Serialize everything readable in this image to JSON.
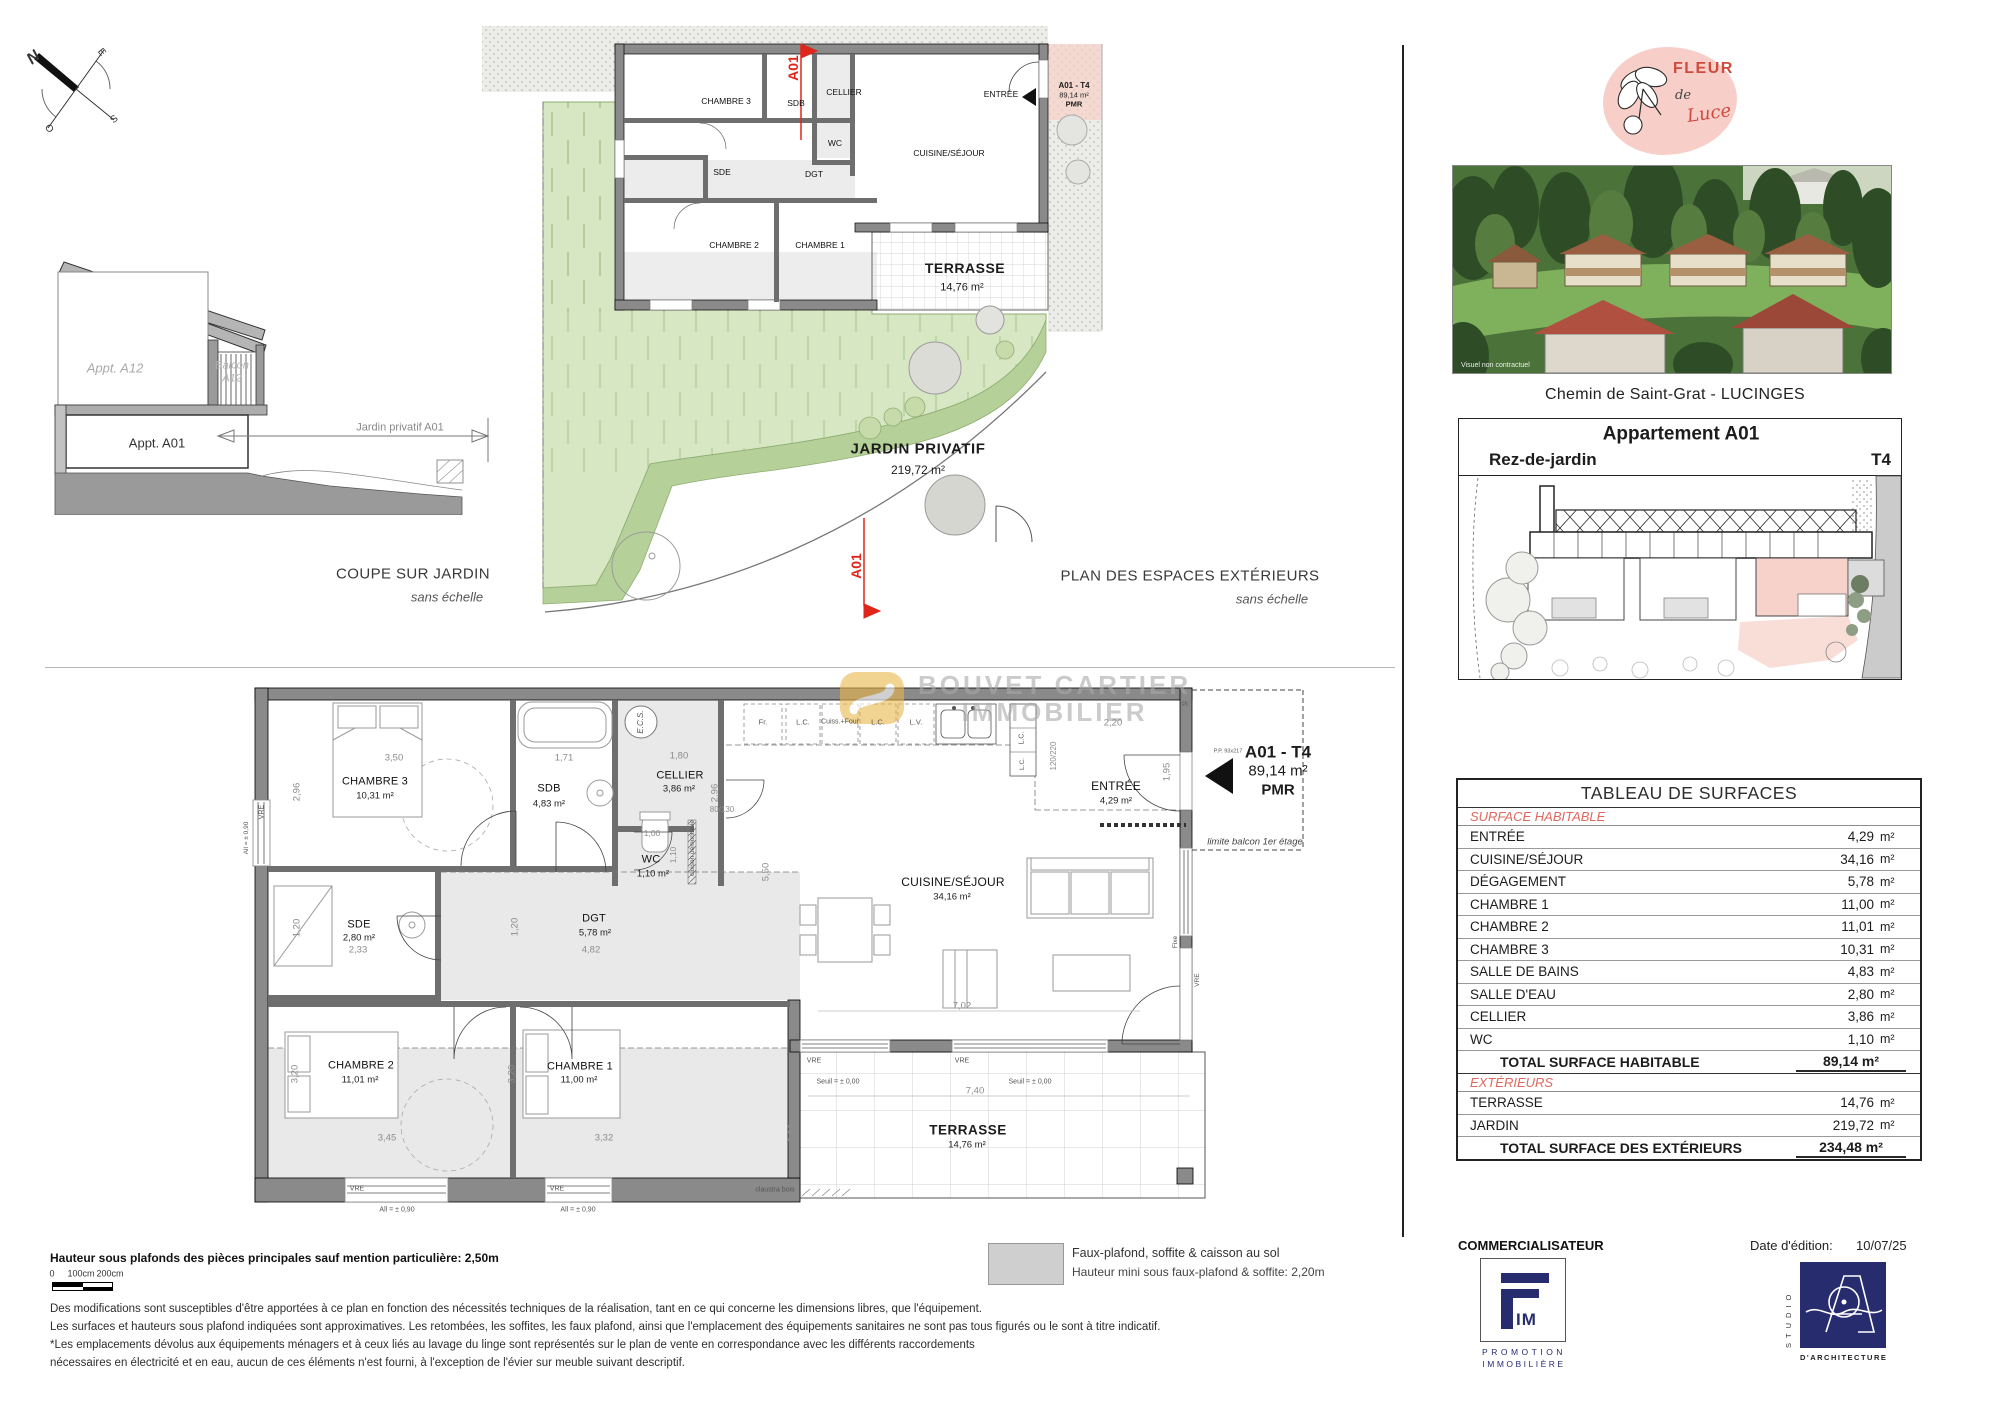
{
  "compass": {
    "n": "N",
    "e": "E",
    "s": "S",
    "o": "O"
  },
  "coupe": {
    "appt_a12": "Appt. A12",
    "balcon_l1": "Balcon",
    "balcon_l2": "A12",
    "appt_a01": "Appt. A01",
    "jardin_dim": "Jardin privatif A01",
    "caption": "COUPE SUR JARDIN",
    "caption_sub": "sans échelle"
  },
  "ext_plan": {
    "caption": "PLAN DES ESPACES EXTÉRIEURS",
    "caption_sub": "sans échelle",
    "jardin_name": "JARDIN PRIVATIF",
    "jardin_area": "219,72 m²",
    "terrasse_name": "TERRASSE",
    "terrasse_area": "14,76 m²",
    "marker": "A01",
    "unit_name": "A01 - T4",
    "unit_area": "89,14 m²",
    "unit_pmr": "PMR",
    "rooms": {
      "chambre3": "CHAMBRE 3",
      "sdb": "SDB",
      "cellier": "CELLIER",
      "entree": "ENTRÉE",
      "cuisine": "CUISINE/SÉJOUR",
      "wc": "WC",
      "sde": "SDE",
      "dgt": "DGT",
      "chambre2": "CHAMBRE 2",
      "chambre1": "CHAMBRE 1"
    }
  },
  "main_plan": {
    "unit_name": "A01 - T4",
    "unit_area": "89,14 m²",
    "unit_pmr": "PMR",
    "rooms": {
      "chambre3": {
        "name": "CHAMBRE 3",
        "area": "10,31 m²"
      },
      "sdb": {
        "name": "SDB",
        "area": "4,83 m²"
      },
      "cellier": {
        "name": "CELLIER",
        "area": "3,86 m²"
      },
      "wc": {
        "name": "WC",
        "area": "1,10 m²"
      },
      "sde": {
        "name": "SDE",
        "area": "2,80 m²"
      },
      "dgt": {
        "name": "DGT",
        "area": "5,78 m²"
      },
      "chambre2": {
        "name": "CHAMBRE 2",
        "area": "11,01 m²"
      },
      "chambre1": {
        "name": "CHAMBRE 1",
        "area": "11,00 m²"
      },
      "cuisine": {
        "name": "CUISINE/SÉJOUR",
        "area": "34,16 m²"
      },
      "entree": {
        "name": "ENTRÉE",
        "area": "4,29 m²"
      },
      "terrasse": {
        "name": "TERRASSE",
        "area": "14,76 m²"
      }
    },
    "dims": {
      "c3w": "3,50",
      "c3h": "2,96",
      "sdbw": "1,71",
      "celw": "1,80",
      "celh": "2,96",
      "win80": "80/130",
      "wcw": "1,00",
      "wch": "1,10",
      "sdew": "2,33",
      "sdeh": "1,20",
      "dgtw": "4,82",
      "dgth": "1,20",
      "c2w": "3,45",
      "c2h": "3,20",
      "c1w": "3,32",
      "c1h": "3,20",
      "sejh": "5,50",
      "sejw": "7,02",
      "terw": "7,40",
      "terh": "2,00",
      "kitw": "2,20",
      "enth": "1,95",
      "door": "120/220"
    },
    "labels": {
      "ecs": "E.C.S.",
      "fr": "Fr.",
      "lc": "L.C.",
      "four": "Cuiss.+Four",
      "lv": "L.V.",
      "vre": "VRE",
      "all": "All = ± 0,90",
      "seuil": "Seuil = ± 0,00",
      "claustra": "claustra bois",
      "cloison": "cloison démontable",
      "fixe": "Fixe",
      "pi": "PI",
      "pp": "P.P. 93x217",
      "limite": "limite balcon 1er étage"
    }
  },
  "watermark": {
    "line1": "BOUVET CARTIER",
    "line2": "IMMOBILIER"
  },
  "panel": {
    "logo": {
      "fleur": "FLEUR",
      "de": "de",
      "luce": "Luce"
    },
    "photo_note": "Visuel non contractuel",
    "address": "Chemin de Saint-Grat - LUCINGES",
    "unit_header": {
      "title": "Appartement A01",
      "level": "Rez-de-jardin",
      "type": "T4"
    },
    "surfaces": {
      "title": "TABLEAU DE SURFACES",
      "habitable_header": "SURFACE HABITABLE",
      "rows": [
        {
          "label": "ENTRÉE",
          "value": "4,29",
          "unit": "m²"
        },
        {
          "label": "CUISINE/SÉJOUR",
          "value": "34,16",
          "unit": "m²"
        },
        {
          "label": "DÉGAGEMENT",
          "value": "5,78",
          "unit": "m²"
        },
        {
          "label": "CHAMBRE 1",
          "value": "11,00",
          "unit": "m²"
        },
        {
          "label": "CHAMBRE 2",
          "value": "11,01",
          "unit": "m²"
        },
        {
          "label": "CHAMBRE 3",
          "value": "10,31",
          "unit": "m²"
        },
        {
          "label": "SALLE DE BAINS",
          "value": "4,83",
          "unit": "m²"
        },
        {
          "label": "SALLE D'EAU",
          "value": "2,80",
          "unit": "m²"
        },
        {
          "label": "CELLIER",
          "value": "3,86",
          "unit": "m²"
        },
        {
          "label": "WC",
          "value": "1,10",
          "unit": "m²"
        }
      ],
      "total_habitable_label": "TOTAL SURFACE HABITABLE",
      "total_habitable_value": "89,14 m²",
      "ext_header": "EXTÉRIEURS",
      "ext_rows": [
        {
          "label": "TERRASSE",
          "value": "14,76",
          "unit": "m²"
        },
        {
          "label": "JARDIN",
          "value": "219,72",
          "unit": "m²"
        }
      ],
      "total_ext_label": "TOTAL SURFACE DES EXTÉRIEURS",
      "total_ext_value": "234,48 m²"
    },
    "footer": {
      "commercialisateur": "COMMERCIALISATEUR",
      "fim_mark": "IM",
      "fim_sub1": "PROMOTION",
      "fim_sub2": "IMMOBILIÈRE",
      "date_label": "Date d'édition:",
      "date_value": "10/07/25",
      "studio_vertical": "STUDIO",
      "studio_sub": "D'ARCHITECTURE"
    }
  },
  "notes": {
    "height": "Hauteur sous plafonds des pièces principales sauf mention particulière: 2,50m",
    "scale0": "0",
    "scale100": "100cm",
    "scale200": "200cm",
    "legend_title": "Faux-plafond, soffite & caisson au sol",
    "legend_sub": "Hauteur mini sous faux-plafond & soffite: 2,20m",
    "d1": "Des modifications sont susceptibles d'être apportées à ce plan en fonction des nécessités techniques de la réalisation, tant en ce qui concerne les dimensions libres, que l'équipement.",
    "d2": "Les surfaces et hauteurs sous plafond indiquées sont approximatives. Les retombées, les soffites, les faux plafond, ainsi que l'emplacement des équipements sanitaires ne sont pas tous figurés ou le sont à titre indicatif.",
    "d3": "*Les emplacements dévolus aux équipements ménagers et à ceux liés au lavage du linge sont représentés sur le plan de vente en correspondance avec les différents raccordements",
    "d4": "nécessaires en électricité et en eau, aucun de ces éléments n'est fourni, à l'exception de l'évier sur meuble suivant descriptif."
  }
}
